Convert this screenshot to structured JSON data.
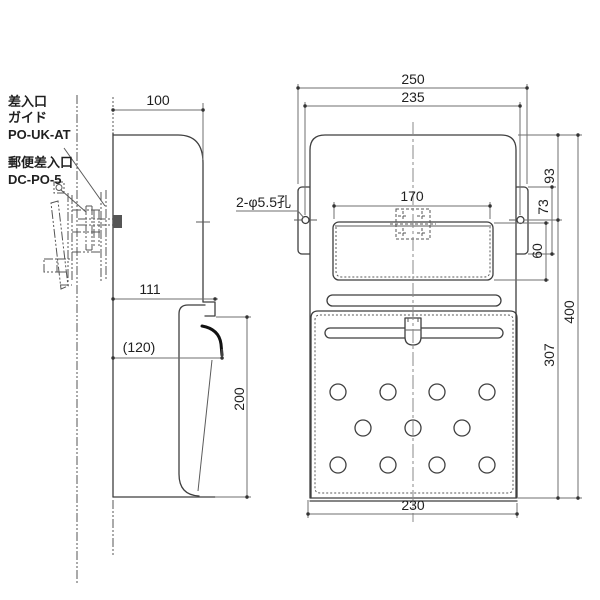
{
  "drawing": {
    "type": "technical-drawing",
    "views": [
      "side-view",
      "front-view"
    ],
    "part_labels": {
      "guide_line1": "差入口",
      "guide_line2": "ガイド",
      "guide_model": "PO-UK-AT",
      "slot_name": "郵便差入口",
      "slot_model": "DC-PO-5"
    },
    "dimensions": {
      "top_depth": "100",
      "overall_width": "250",
      "mount_hole_pitch": "235",
      "flap_width": "170",
      "top_to_hole": "93",
      "guide_plate_height": "73",
      "flap_height": "60",
      "overall_height": "400",
      "hole_to_bottom": "307",
      "upper_depth": "111",
      "door_swing_depth": "(120)",
      "door_height": "200",
      "body_width": "230",
      "hole_note": "2-φ5.5孔"
    },
    "colors": {
      "background": "#ffffff",
      "object_line": "#3f3f3f",
      "dimension_line": "#6f6f6f",
      "text": "#1f1f1f"
    }
  }
}
